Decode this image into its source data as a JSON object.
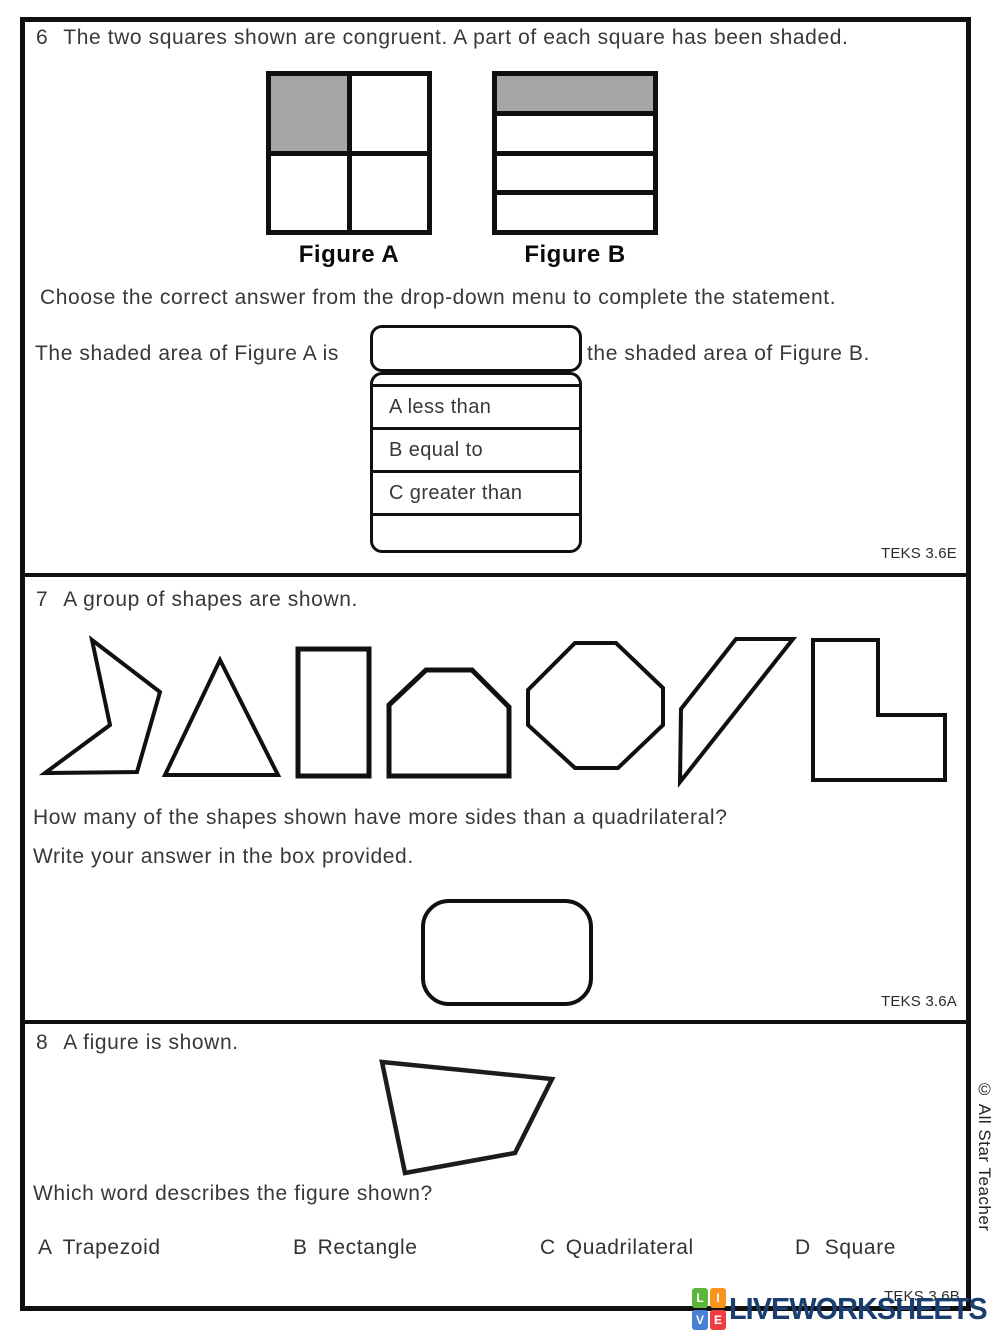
{
  "q6": {
    "number": "6",
    "prompt": "The two squares shown are congruent. A part of each square has been shaded.",
    "figures": [
      {
        "label": "Figure A",
        "type": "square-quarters",
        "shaded": "top-left quarter"
      },
      {
        "label": "Figure B",
        "type": "square-fourths-rows",
        "shaded": "top row"
      }
    ],
    "instruction": "Choose the correct answer from the drop-down menu to complete the statement.",
    "statement_before": "The shaded area of Figure A is",
    "statement_after": "the shaded area of Figure B.",
    "dropdown": {
      "selected_value": "",
      "options": [
        {
          "label": "A less than"
        },
        {
          "label": "B equal to"
        },
        {
          "label": "C greater than"
        }
      ]
    },
    "teks": "TEKS 3.6E"
  },
  "q7": {
    "number": "7",
    "prompt": "A group of shapes are shown.",
    "shapes": [
      "concave-pentagon",
      "triangle",
      "rectangle",
      "hexagon",
      "octagon",
      "parallelogram",
      "l-shape"
    ],
    "question": "How many of the shapes shown have more sides than a quadrilateral?",
    "instruction": "Write your answer in the box provided.",
    "answer_value": "",
    "teks": "TEKS 3.6A"
  },
  "q8": {
    "number": "8",
    "prompt": "A figure is shown.",
    "figure": "irregular-quadrilateral",
    "question": "Which word describes the figure shown?",
    "options": [
      {
        "letter": "A",
        "label": "Trapezoid"
      },
      {
        "letter": "B",
        "label": "Rectangle"
      },
      {
        "letter": "C",
        "label": "Quadrilateral"
      },
      {
        "letter": "D",
        "label": "Square"
      }
    ],
    "teks": "TEKS 3.6B"
  },
  "footer": {
    "logo": {
      "blocks": [
        {
          "letter": "L",
          "color": "#5eb73d"
        },
        {
          "letter": "I",
          "color": "#f7941e"
        },
        {
          "letter": "V",
          "color": "#4a7fd6"
        },
        {
          "letter": "E",
          "color": "#ee3e44"
        }
      ],
      "text": "LIVEWORKSHEETS",
      "text_color": "#1a3e6f"
    },
    "copyright": "© All Star Teacher"
  },
  "colors": {
    "shaded": "#a6a6a6",
    "ink": "#101010",
    "text": "#383838"
  }
}
